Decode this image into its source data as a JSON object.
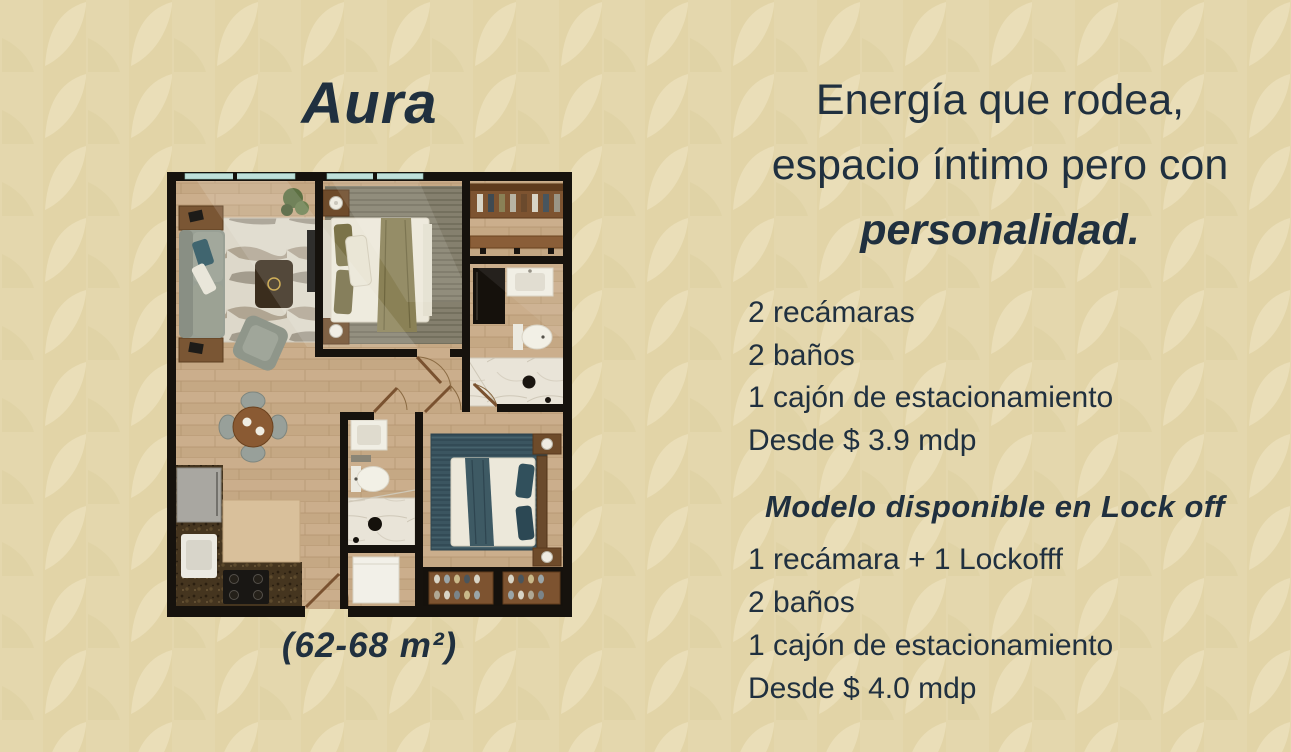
{
  "left_panel": {
    "title": "Aura",
    "area_caption": "(62-68 m²)"
  },
  "right_panel": {
    "headline_line1": "Energía que rodea,",
    "headline_line2": "espacio íntimo pero con",
    "headline_line3": "personalidad.",
    "standard": {
      "items": [
        "2 recámaras",
        "2 baños",
        "1 cajón de estacionamiento",
        "Desde $ 3.9 mdp"
      ]
    },
    "lockoff": {
      "heading": "Modelo disponible en Lock off",
      "items": [
        "1 recámara + 1 Lockofff",
        "2 baños",
        "1 cajón de estacionamiento",
        "Desde $ 4.0 mdp"
      ]
    }
  },
  "colors": {
    "background": "#e4d7ad",
    "text": "#20303f",
    "plan_wall": "#16120d",
    "wood_floor": "#c9ac8a",
    "window_glass": "#bfe0da",
    "bedroom2_rug": "#3b5560"
  }
}
